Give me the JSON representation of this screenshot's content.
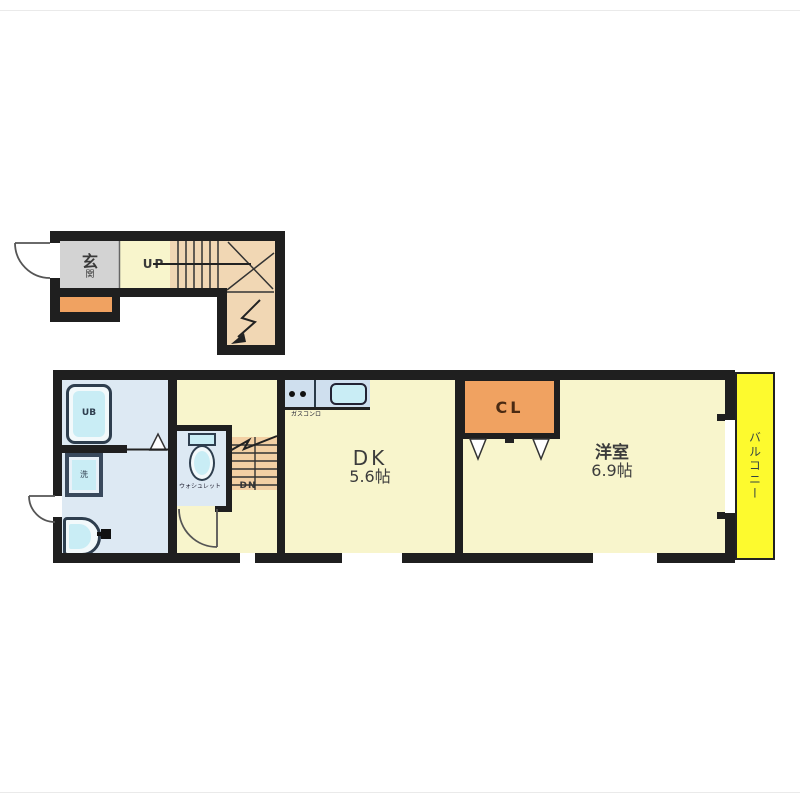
{
  "colors": {
    "wall": "#1f1f1f",
    "room-yellow": "#f8f5cc",
    "genkan-gray": "#d3d3d3",
    "stair-beige": "#f1d7b4",
    "stair-beige2": "#f3d0a4",
    "accent-orange": "#f0a261",
    "wash-blue": "#dde9f3",
    "fixture-cyan": "#c9edf5",
    "counter-blue": "#cfdfee",
    "balcony-yellow": "#fdfa2e"
  },
  "floor1": {
    "genkan_1": "玄",
    "genkan_2": "関",
    "up": "UP"
  },
  "floor2": {
    "ub": "UB",
    "washer": "洗",
    "toilet_note": "ウォシュレット",
    "dn": "DN",
    "kitchen_note": "ガスコンロ",
    "dk_name": "DK",
    "dk_size": "5.6帖",
    "cl": "CL",
    "room_name": "洋室",
    "room_size": "6.9帖",
    "balcony": "バルコニー"
  }
}
